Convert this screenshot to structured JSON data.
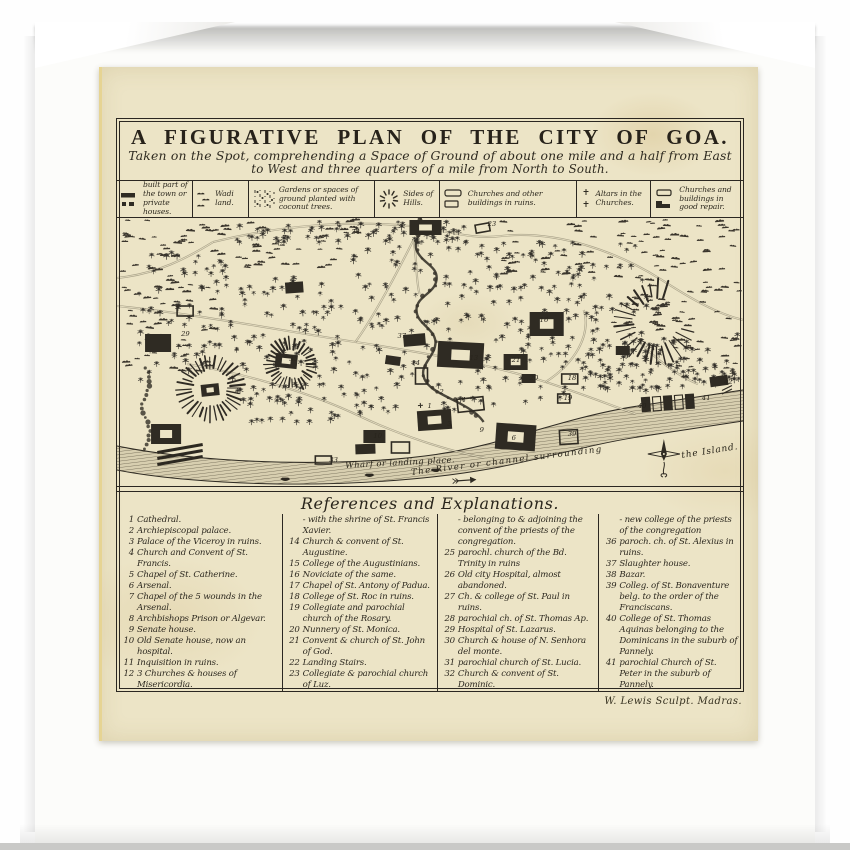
{
  "plate": {
    "title": "A FIGURATIVE PLAN OF THE CITY OF GOA.",
    "subtitle_line1": "Taken on the Spot, comprehending a Space of Ground of about one mile and a half from East",
    "subtitle_line2": "to West and three quarters of a mile from North to South.",
    "attribution": "W. Lewis Sculpt. Madras.",
    "ink_color": "#2f2b23",
    "paper_color": "#ece4c6"
  },
  "legend": {
    "items": [
      {
        "icon": "built-town-icon",
        "label": "built part of the town or private houses."
      },
      {
        "icon": "wadi-land-icon",
        "label": "Wadi land."
      },
      {
        "icon": "coconut-gardens-icon",
        "label": "Gardens or spaces of ground planted with coconut trees."
      },
      {
        "icon": "hill-sides-icon",
        "label": "Sides of Hills."
      },
      {
        "icon": "ruins-icon",
        "label": "Churches and other buildings in ruins."
      },
      {
        "icon": "altars-icon",
        "label": "Altars in the Churches."
      },
      {
        "icon": "good-repair-icon",
        "label": "Churches and buildings in good repair."
      }
    ]
  },
  "map": {
    "labels": {
      "wharf": "Wharf or landing place.",
      "river": "The River or channel surrounding",
      "island": "the Island."
    },
    "numbers": [
      {
        "n": "29",
        "x": 64,
        "y": 118
      },
      {
        "n": "35",
        "x": 172,
        "y": 143
      },
      {
        "n": "33",
        "x": 212,
        "y": 244
      },
      {
        "n": "37",
        "x": 280,
        "y": 120
      },
      {
        "n": "13",
        "x": 352,
        "y": 142
      },
      {
        "n": "14",
        "x": 294,
        "y": 147
      },
      {
        "n": "1",
        "x": 310,
        "y": 190
      },
      {
        "n": "4",
        "x": 344,
        "y": 184
      },
      {
        "n": "6",
        "x": 394,
        "y": 222
      },
      {
        "n": "10",
        "x": 256,
        "y": 220
      },
      {
        "n": "21",
        "x": 394,
        "y": 144
      },
      {
        "n": "20",
        "x": 412,
        "y": 162
      },
      {
        "n": "18",
        "x": 450,
        "y": 162
      },
      {
        "n": "19",
        "x": 446,
        "y": 182
      },
      {
        "n": "16",
        "x": 422,
        "y": 104
      },
      {
        "n": "39",
        "x": 450,
        "y": 218
      },
      {
        "n": "24",
        "x": 234,
        "y": 16
      },
      {
        "n": "23",
        "x": 370,
        "y": 8
      },
      {
        "n": "40",
        "x": 520,
        "y": 190
      },
      {
        "n": "41",
        "x": 584,
        "y": 182
      },
      {
        "n": "42",
        "x": 606,
        "y": 166
      },
      {
        "n": "3",
        "x": 330,
        "y": 208
      },
      {
        "n": "9",
        "x": 362,
        "y": 214
      },
      {
        "n": "2",
        "x": 322,
        "y": 176
      }
    ],
    "buildings": [
      {
        "x": 286,
        "y": 116,
        "w": 22,
        "h": 12,
        "t": "solid",
        "rot": -5
      },
      {
        "x": 320,
        "y": 124,
        "w": 46,
        "h": 26,
        "t": "court",
        "rot": 3
      },
      {
        "x": 268,
        "y": 138,
        "w": 15,
        "h": 9,
        "t": "solid",
        "rot": 8
      },
      {
        "x": 298,
        "y": 150,
        "w": 12,
        "h": 16,
        "t": "open",
        "rot": 0
      },
      {
        "x": 300,
        "y": 192,
        "w": 34,
        "h": 20,
        "t": "church",
        "rot": -4
      },
      {
        "x": 340,
        "y": 180,
        "w": 26,
        "h": 13,
        "t": "open",
        "rot": -6
      },
      {
        "x": 378,
        "y": 206,
        "w": 40,
        "h": 26,
        "t": "court",
        "rot": 4
      },
      {
        "x": 246,
        "y": 212,
        "w": 22,
        "h": 13,
        "t": "solid",
        "rot": 0
      },
      {
        "x": 386,
        "y": 136,
        "w": 24,
        "h": 16,
        "t": "court",
        "rot": 0
      },
      {
        "x": 404,
        "y": 156,
        "w": 14,
        "h": 9,
        "t": "solid",
        "rot": 0
      },
      {
        "x": 444,
        "y": 156,
        "w": 16,
        "h": 10,
        "t": "open",
        "rot": 0
      },
      {
        "x": 440,
        "y": 176,
        "w": 12,
        "h": 9,
        "t": "open",
        "rot": 0
      },
      {
        "x": 412,
        "y": 94,
        "w": 34,
        "h": 24,
        "t": "court",
        "rot": 0
      },
      {
        "x": 442,
        "y": 212,
        "w": 18,
        "h": 14,
        "t": "open",
        "rot": -3
      },
      {
        "x": 198,
        "y": 238,
        "w": 16,
        "h": 8,
        "t": "open",
        "rot": 0
      },
      {
        "x": 158,
        "y": 136,
        "w": 22,
        "h": 14,
        "t": "court",
        "rot": 6
      },
      {
        "x": 84,
        "y": 166,
        "w": 18,
        "h": 12,
        "t": "court",
        "rot": -6
      },
      {
        "x": 28,
        "y": 116,
        "w": 26,
        "h": 18,
        "t": "solid",
        "rot": 0
      },
      {
        "x": 34,
        "y": 206,
        "w": 30,
        "h": 20,
        "t": "court",
        "rot": 0
      },
      {
        "x": 292,
        "y": 2,
        "w": 32,
        "h": 15,
        "t": "court",
        "rot": 0
      },
      {
        "x": 358,
        "y": 6,
        "w": 14,
        "h": 8,
        "t": "open",
        "rot": -10
      },
      {
        "x": 524,
        "y": 178,
        "w": 50,
        "h": 14,
        "t": "suburb",
        "rot": -4
      },
      {
        "x": 592,
        "y": 158,
        "w": 18,
        "h": 10,
        "t": "solid",
        "rot": -8
      },
      {
        "x": 238,
        "y": 226,
        "w": 20,
        "h": 10,
        "t": "solid",
        "rot": -2
      },
      {
        "x": 274,
        "y": 224,
        "w": 18,
        "h": 11,
        "t": "open",
        "rot": 0
      },
      {
        "x": 168,
        "y": 64,
        "w": 18,
        "h": 11,
        "t": "solid",
        "rot": -4
      },
      {
        "x": 60,
        "y": 88,
        "w": 16,
        "h": 10,
        "t": "open",
        "rot": 0
      },
      {
        "x": 498,
        "y": 128,
        "w": 14,
        "h": 9,
        "t": "solid",
        "rot": 0
      }
    ],
    "hills": [
      {
        "cx": 93,
        "cy": 170,
        "r": 30,
        "a0": 0,
        "a1": 360
      },
      {
        "cx": 174,
        "cy": 146,
        "r": 24,
        "a0": 0,
        "a1": 360
      },
      {
        "cx": 538,
        "cy": 104,
        "r": 38,
        "a0": 15,
        "a1": 300
      }
    ]
  },
  "references": {
    "heading": "References and Explanations.",
    "columns": [
      {
        "entries": [
          {
            "n": "1",
            "text": "Cathedral."
          },
          {
            "n": "2",
            "text": "Archiepiscopal palace."
          },
          {
            "n": "3",
            "text": "Palace of the Viceroy in ruins."
          },
          {
            "n": "4",
            "text": "Church and Convent of St. Francis."
          },
          {
            "n": "5",
            "text": "Chapel of St. Catherine."
          },
          {
            "n": "6",
            "text": "Arsenal."
          },
          {
            "n": "7",
            "text": "Chapel of the 5 wounds in the Arsenal."
          },
          {
            "n": "8",
            "text": "Archbishops Prison or Algevar."
          },
          {
            "n": "9",
            "text": "Senate house."
          },
          {
            "n": "10",
            "text": "Old Senate house, now an hospital."
          },
          {
            "n": "11",
            "text": "Inquisition in ruins."
          },
          {
            "n": "12",
            "text": "3 Churches & houses of Misericordia."
          },
          {
            "n": "13",
            "text": "Church and house of Bom Jesus-"
          }
        ]
      },
      {
        "entries": [
          {
            "n": "",
            "text": "- with the shrine of St. Francis Xavier."
          },
          {
            "n": "14",
            "text": "Church & convent of St. Augustine."
          },
          {
            "n": "15",
            "text": "College of the Augustinians."
          },
          {
            "n": "16",
            "text": "Noviciate of the same."
          },
          {
            "n": "17",
            "text": "Chapel of St. Antony of Padua."
          },
          {
            "n": "18",
            "text": "College of St. Roc in ruins."
          },
          {
            "n": "19",
            "text": "Collegiate and parochial church of the Rosary."
          },
          {
            "n": "20",
            "text": "Nunnery of St. Monica."
          },
          {
            "n": "21",
            "text": "Convent & church of St. John of God."
          },
          {
            "n": "22",
            "text": "Landing Stairs."
          },
          {
            "n": "23",
            "text": "Collegiate & parochial church of Luz."
          },
          {
            "n": "24",
            "text": "Church of the miraculous cross-"
          }
        ]
      },
      {
        "entries": [
          {
            "n": "",
            "text": "- belonging to & adjoining the convent of the priests of the congregation."
          },
          {
            "n": "25",
            "text": "parochl. church of the Bd. Trinity in ruins"
          },
          {
            "n": "26",
            "text": "Old city Hospital, almost abandoned."
          },
          {
            "n": "27",
            "text": "Ch. & college of St. Paul in ruins."
          },
          {
            "n": "28",
            "text": "parochial ch. of St. Thomas Ap."
          },
          {
            "n": "29",
            "text": "Hospital of St. Lazarus."
          },
          {
            "n": "30",
            "text": "Church & house of N. Senhora del monte."
          },
          {
            "n": "31",
            "text": "parochial church of St. Lucia."
          },
          {
            "n": "32",
            "text": "Church & convent of St. Dominic."
          },
          {
            "n": "33",
            "text": "Old Custom house in ruins."
          },
          {
            "n": "34",
            "text": "Church & convent of St. Cajetan."
          },
          {
            "n": "35",
            "text": "and ch. & convent of the Carmelites-"
          }
        ]
      },
      {
        "entries": [
          {
            "n": "",
            "text": "- new college of the priests of the congregation"
          },
          {
            "n": "36",
            "text": "paroch. ch. of St. Alexius in ruins."
          },
          {
            "n": "37",
            "text": "Slaughter house."
          },
          {
            "n": "38",
            "text": "Bazar."
          },
          {
            "n": "39",
            "text": "Colleg. of St. Bonaventure belg. to the order of the Franciscans."
          },
          {
            "n": "40",
            "text": "College of St. Thomas Aquinas belonging to the Dominicans in the suburb of Pannely."
          },
          {
            "n": "41",
            "text": "parochial Church of St. Peter in the suburb of Pannely."
          },
          {
            "n": "42",
            "text": "Bridge over the ditch, the waters of which flow from the hills."
          }
        ]
      }
    ]
  }
}
